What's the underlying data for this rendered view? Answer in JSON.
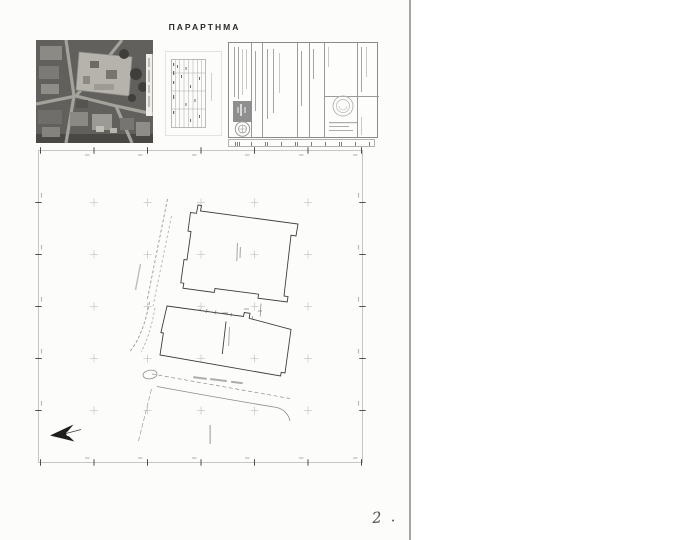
{
  "page": {
    "title": "ΠΑΡΑΡΤΗΜΑ",
    "handwritten_note": "2 .",
    "colors": {
      "paper": "#fcfcfb",
      "ink": "#3e3e3e",
      "faint_grid": "#c9c9c9",
      "frame": "#b8b8b8",
      "page_edge": "#a6a6a6",
      "photo_dark": "#5e5d59",
      "north_arrow": "#1d1d1d"
    }
  }
}
